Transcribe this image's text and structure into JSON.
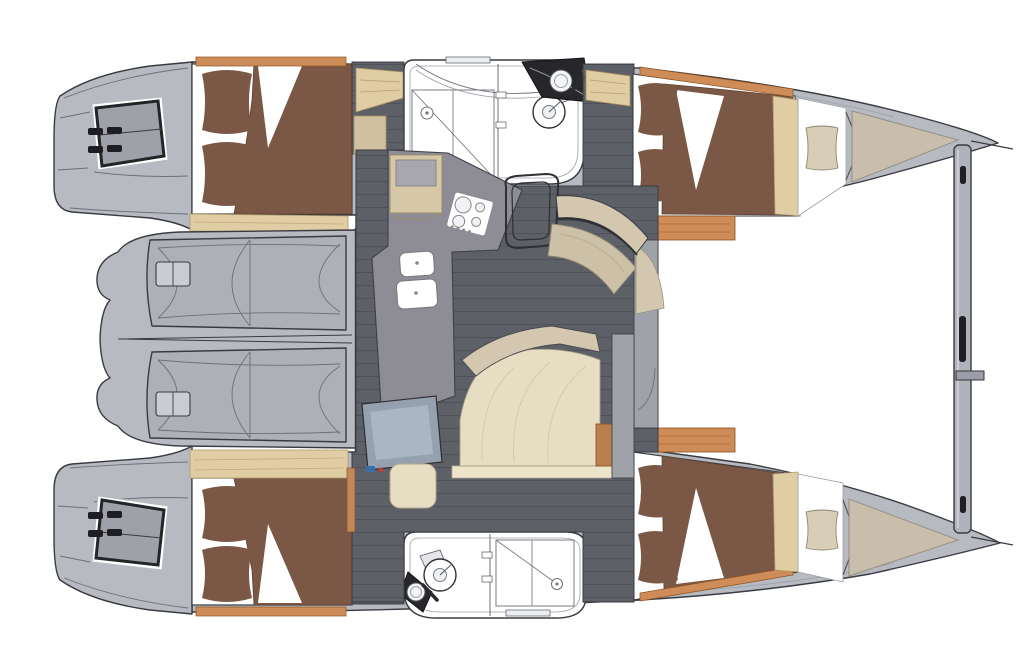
{
  "document": {
    "type": "boat-deck-plan",
    "subject": "catamaran interior layout, top view, bows to the right",
    "background": "#ffffff"
  },
  "counts": {
    "hulls": 2,
    "double_cabins": 4,
    "bathrooms": 2,
    "transom_platforms": 2,
    "cockpit_bench_seats": 2
  },
  "areas": {
    "port_hull": [
      "transom-steps",
      "aft-double-cabin",
      "bathroom-shower-toilet-sink",
      "forward-double-cabin",
      "forepeak-cushion",
      "bow-locker"
    ],
    "starboard_hull": [
      "transom-steps",
      "aft-double-cabin",
      "bathroom-toilet-sink-shower",
      "forward-double-cabin",
      "forepeak-cushion",
      "bow-locker"
    ],
    "bridgedeck": [
      "aft-cockpit-moulded-seats",
      "saloon-floor",
      "galley-l-counter",
      "gas-cooktop",
      "double-sink",
      "fridge-cabinet",
      "dinette-curved-table",
      "dinette-curved-bench",
      "chair",
      "forward-lounge-seat",
      "chart-table",
      "chart-table-stool"
    ],
    "foredeck": [
      "forward-crossbeam-with-fittings",
      "bow-tips"
    ]
  },
  "colors": {
    "white": "#ffffff",
    "outline": "#3a3b41",
    "hull_gray": "#b7bac1",
    "seat_gray": "#adb0b7",
    "winch_gray": "#c9ccd1",
    "window_gray": "#9ea1a8",
    "wall_gray": "#9fa2a9",
    "beam_gray": "#b0b3ba",
    "floor_dark": "#5d6067",
    "floor_line": "#4e5158",
    "counter_gray": "#8e8d95",
    "bed_brown": "#7a5845",
    "wood_orange": "#ce8d58",
    "wood_light": "#e0cda4",
    "furniture_beige": "#d3c8af",
    "seat_pad": "#e7ddc2",
    "bench_beige": "#ccc1a7",
    "bow_beige": "#c8beab",
    "forepeak_beige": "#d8cdb6",
    "fridge_beige": "#d6c8a6",
    "nav_slate": "#95a1ae",
    "nav_panel": "#aab6c1",
    "dark_fixture": "#26262b",
    "chip_blue": "#3a6ea8",
    "chip_red": "#c03b30"
  }
}
